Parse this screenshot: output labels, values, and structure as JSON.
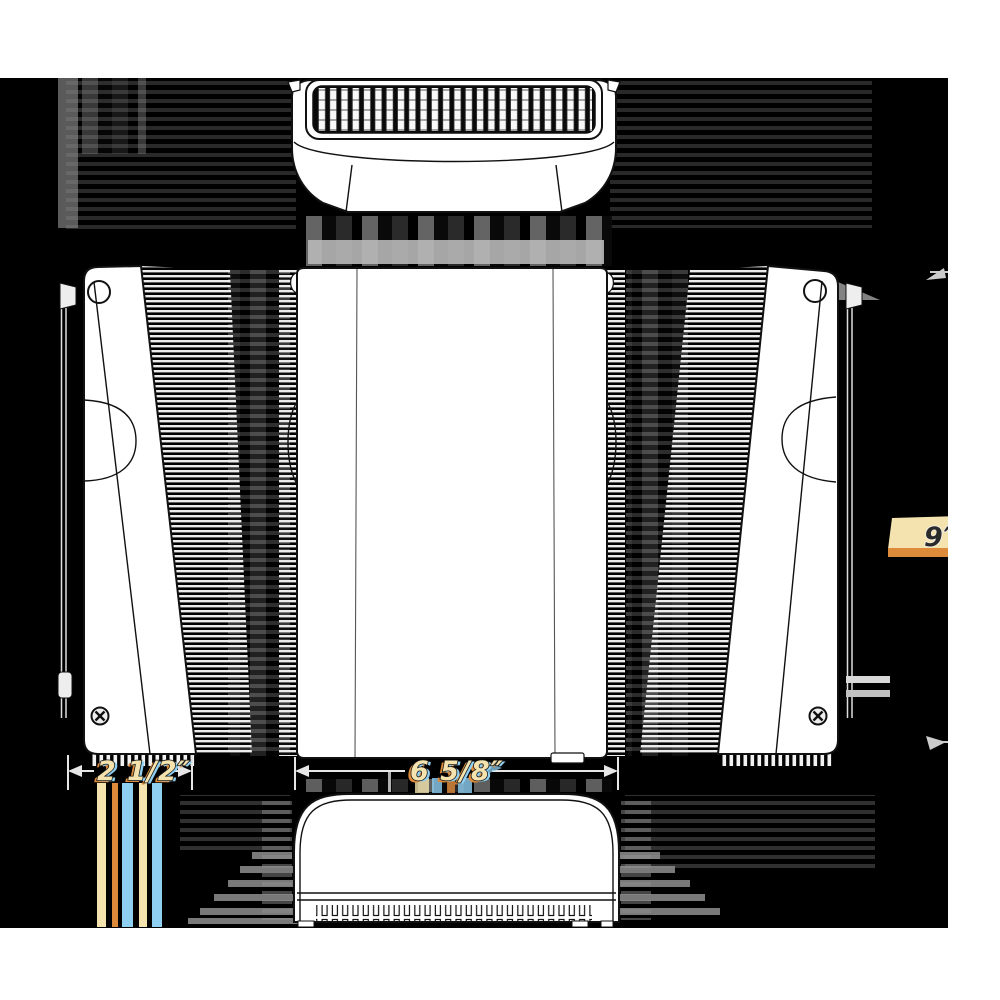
{
  "canvas": {
    "background": "#ffffff",
    "drawing_area_background": "#000000"
  },
  "drawing": {
    "kind": "orthographic-technical-drawing",
    "views": [
      "top-view",
      "front-view",
      "left-side-view",
      "right-side-view",
      "bottom-view"
    ],
    "dimensions": {
      "depth": "2 1/2″",
      "width": "6 5/8″",
      "height": "9″"
    },
    "colors": {
      "label_cream": "#f4e3ae",
      "label_orange": "#dd8a3a",
      "label_blue": "#8fd0f2",
      "outline": "#111111"
    }
  }
}
